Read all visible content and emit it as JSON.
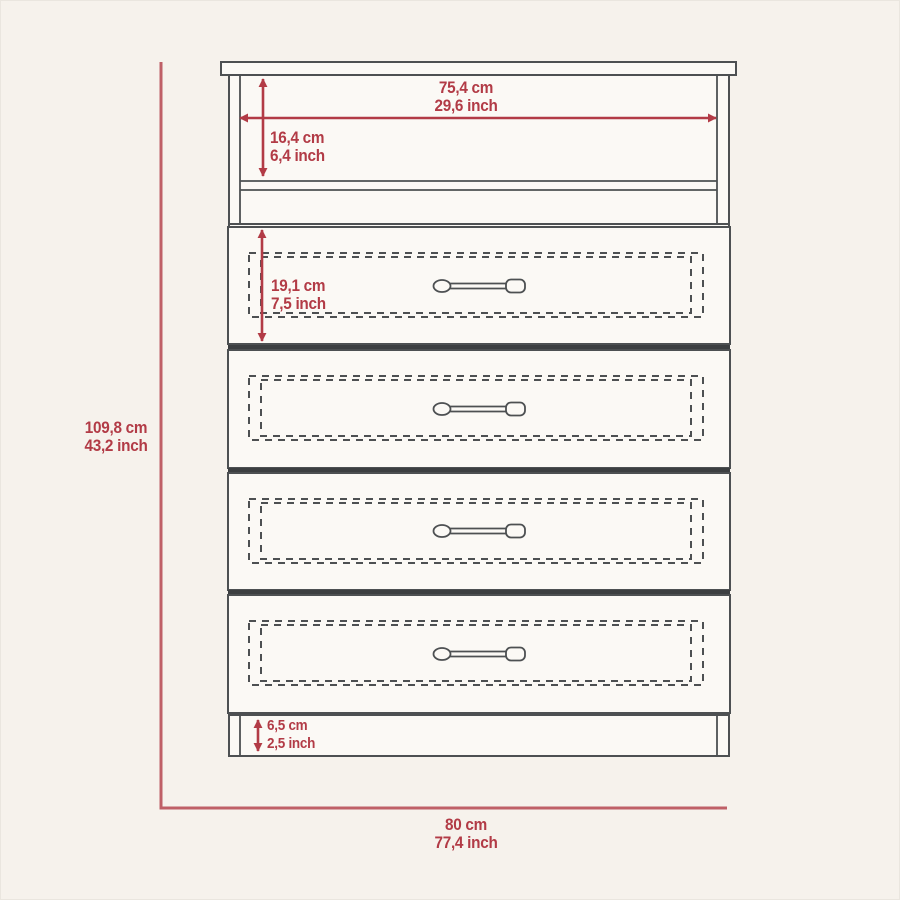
{
  "colors": {
    "dimension_red": "#b23b46",
    "line_gray": "#4d5052",
    "line_dark": "#3c3f41",
    "background": "#f6f2ec",
    "panel_fill": "#fbf9f5"
  },
  "diagram": {
    "subject": "four-drawer-dresser-front-elevation",
    "dimensions": {
      "inner_width": {
        "cm": "75,4 cm",
        "inch": "29,6 inch"
      },
      "top_compartment_height": {
        "cm": "16,4 cm",
        "inch": "6,4 inch"
      },
      "drawer_height": {
        "cm": "19,1 cm",
        "inch": "7,5 inch"
      },
      "overall_height": {
        "cm": "109,8 cm",
        "inch": "43,2 inch"
      },
      "base_height": {
        "cm": "6,5 cm",
        "inch": "2,5 inch"
      },
      "overall_width": {
        "cm": "80 cm",
        "inch": "77,4 inch"
      }
    }
  }
}
